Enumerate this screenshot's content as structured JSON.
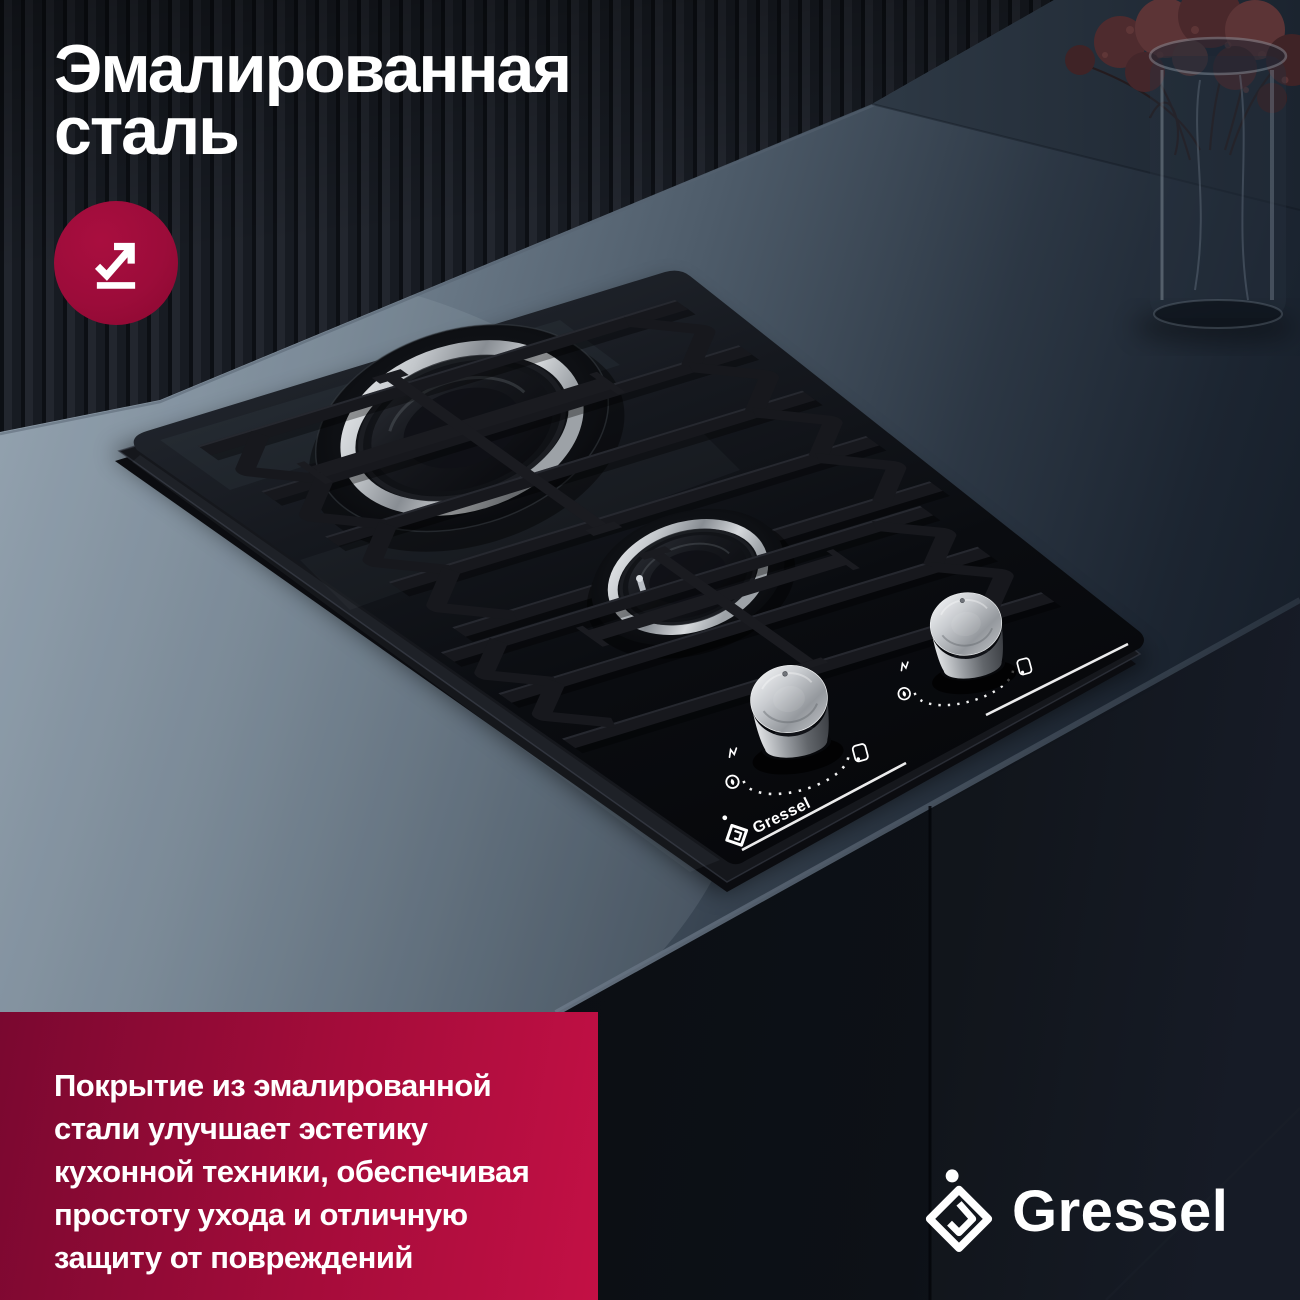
{
  "headline": {
    "line1": "Эмалированная",
    "line2": "сталь"
  },
  "feature_badge": {
    "icon": "arrow-growth-underline-icon",
    "bg_color": "#9c0c3a",
    "icon_color": "#ffffff"
  },
  "description_panel": {
    "lines": [
      "Покрытие из эмалированной",
      "стали улучшает эстетику",
      "кухонной техники, обеспечивая",
      "простоту ухода и отличную",
      "защиту от повреждений"
    ],
    "bg_gradient": [
      "#7a0830",
      "#c31045"
    ],
    "text_color": "#ffffff"
  },
  "brand": {
    "name": "Gressel",
    "icon": "gressel-diamond-g-icon",
    "color": "#ffffff"
  },
  "hob": {
    "glass_print": "Gressel",
    "burners_visible": 2,
    "knobs_visible": 2,
    "dial_symbols": [
      "mini-flame-icon",
      "flame-circle-icon",
      "off-square-icon"
    ]
  }
}
